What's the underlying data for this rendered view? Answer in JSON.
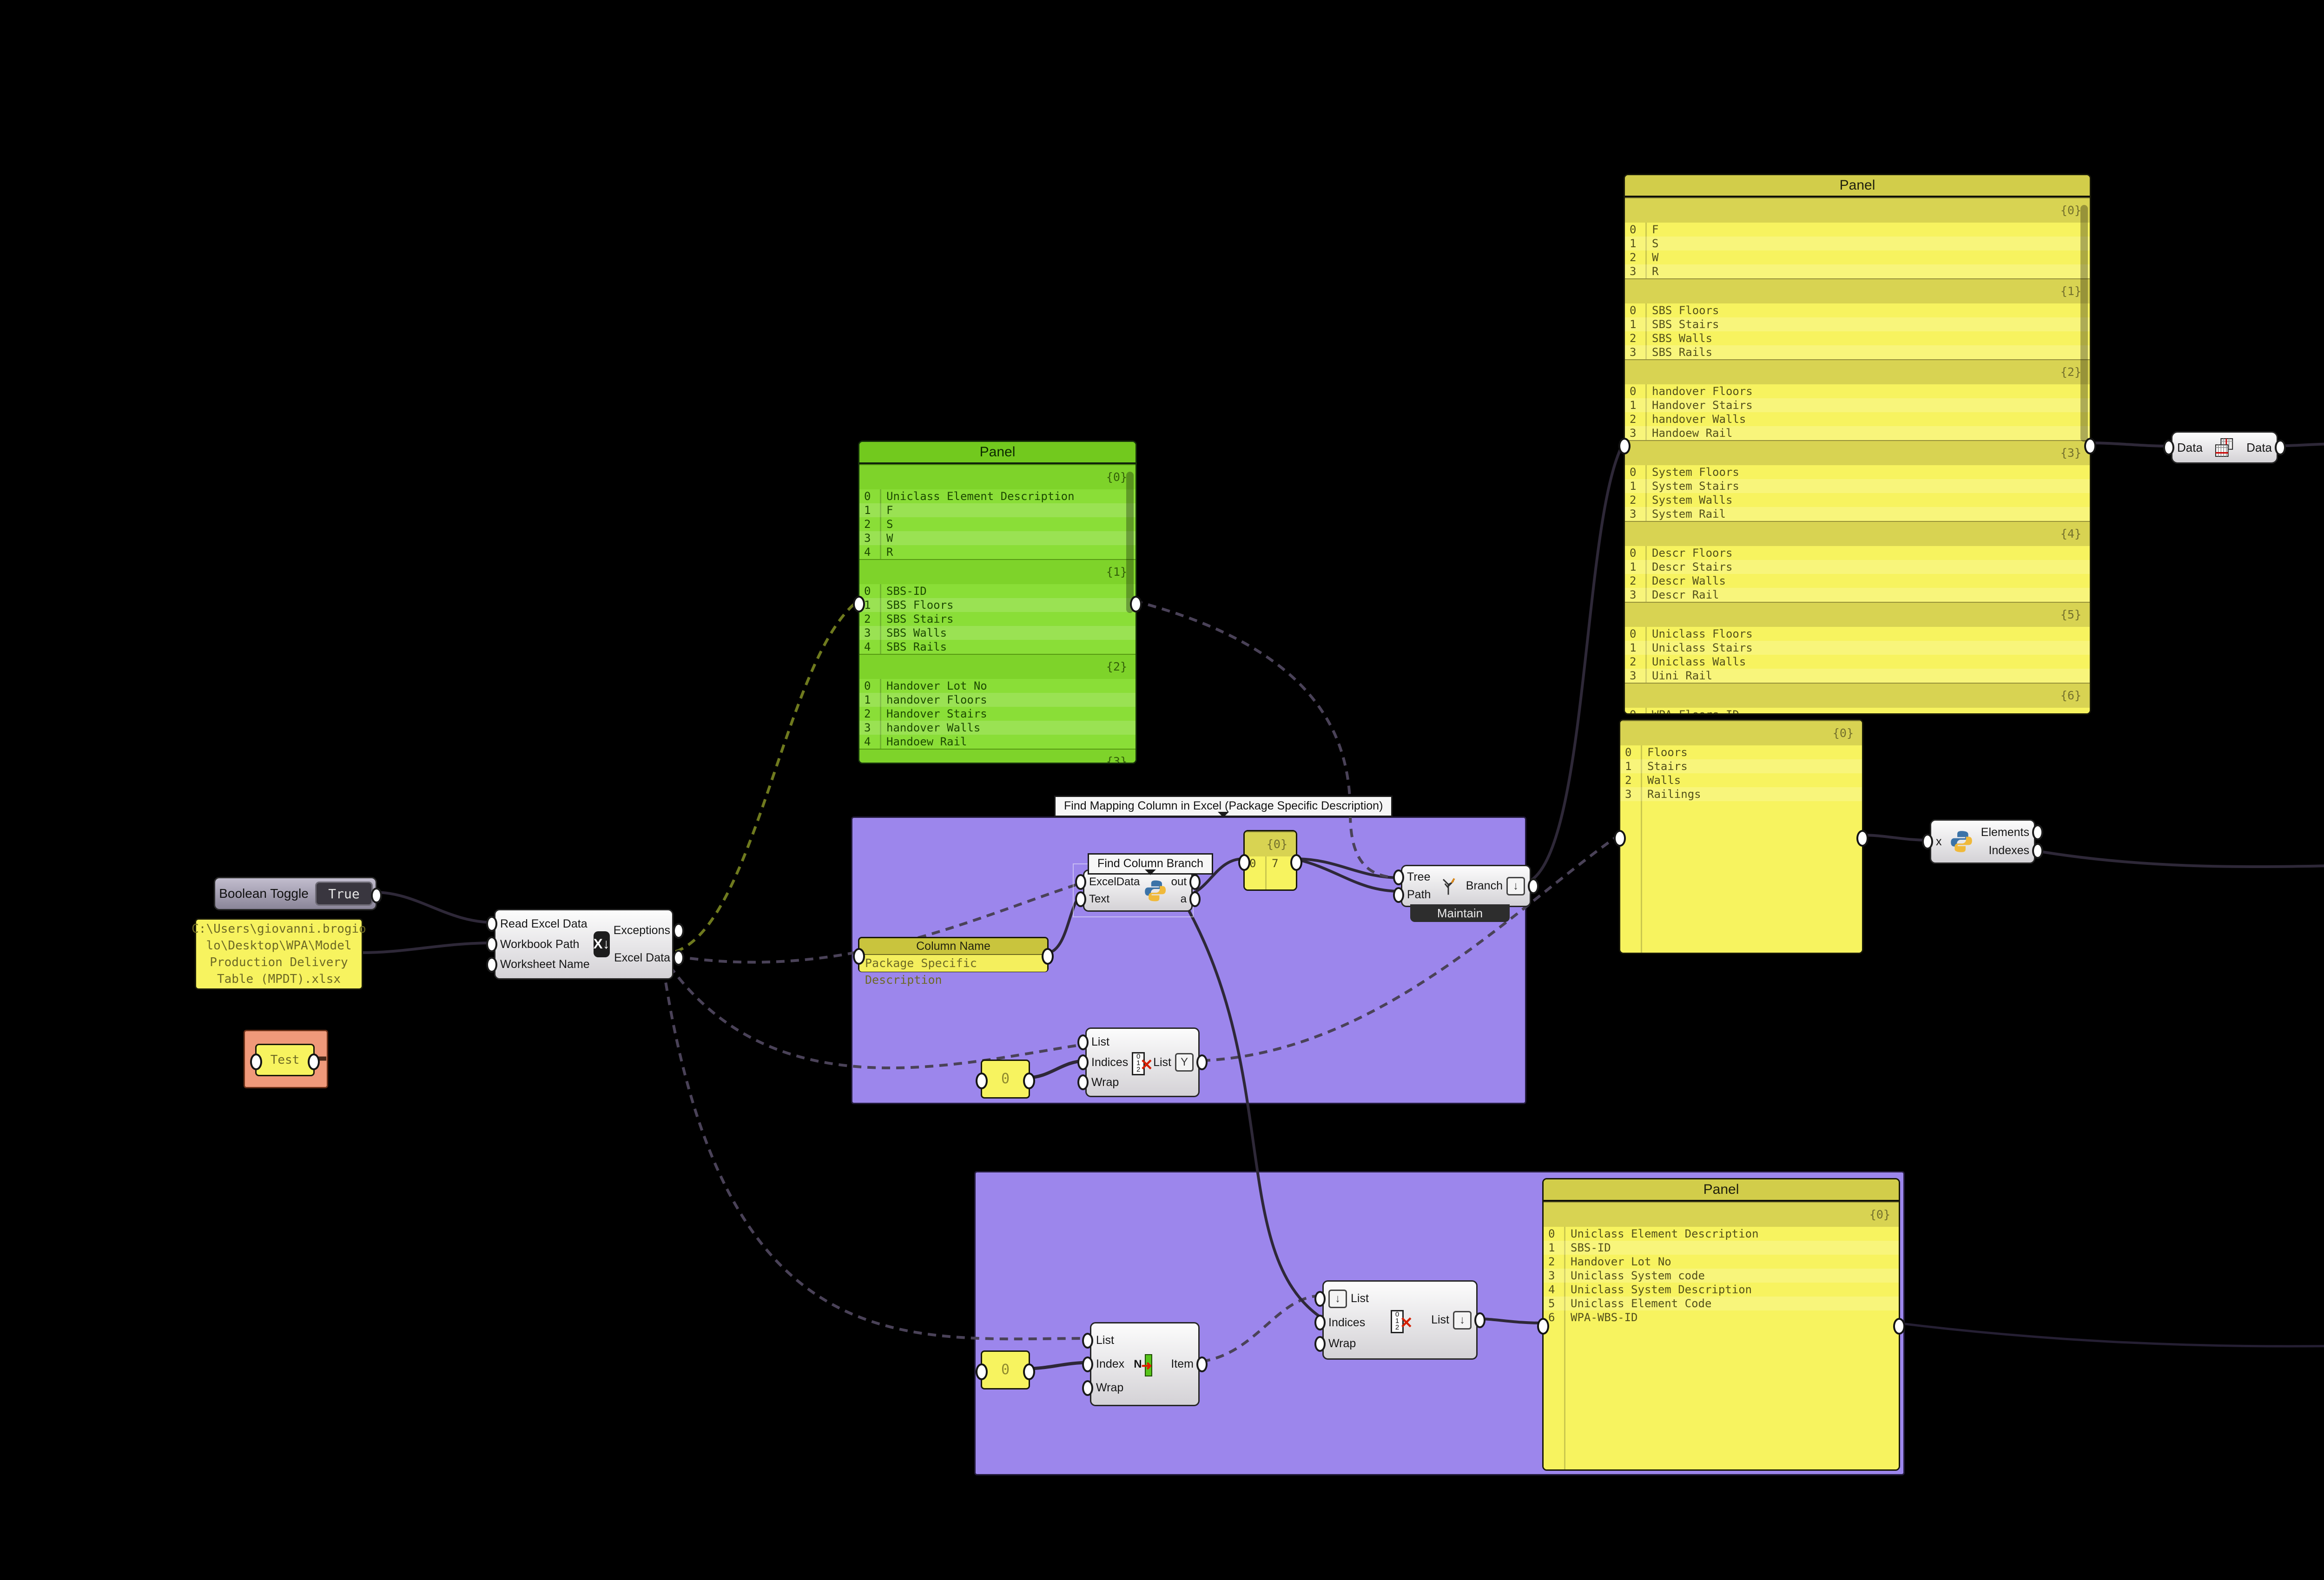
{
  "toggle": {
    "label": "Boolean Toggle",
    "value": "True"
  },
  "filepath_panel": {
    "text": "C:\\Users\\giovanni.brogio\nlo\\Desktop\\WPA\\Model\nProduction Delivery\nTable (MPDT).xlsx"
  },
  "test_group": {
    "panel_text": "Test"
  },
  "read_excel": {
    "inputs": [
      "Read Excel Data",
      "Workbook Path",
      "Worksheet Name"
    ],
    "outputs": [
      "Exceptions",
      "Excel Data"
    ],
    "icon_label": "X↓"
  },
  "group_find_mapping": {
    "tag": "Find Mapping Column in Excel (Package Specific Description)"
  },
  "find_column_branch": {
    "tag": "Find Column Branch",
    "inputs": [
      "ExcelData",
      "Text"
    ],
    "outputs": [
      "out",
      "a"
    ]
  },
  "column_name": {
    "title": "Column Name",
    "value": "Package Specific Description"
  },
  "col7_panel": {
    "sections": [
      {
        "key": "{0}",
        "rows": [
          "7"
        ]
      }
    ]
  },
  "tree_branch": {
    "inputs": [
      "Tree",
      "Path"
    ],
    "outputs": [
      "Branch"
    ],
    "mode": "Maintain"
  },
  "zero_a": {
    "value": "0"
  },
  "zero_b": {
    "value": "0"
  },
  "list_top": {
    "inputs": [
      "List",
      "Indices",
      "Wrap"
    ],
    "outputs": [
      "List"
    ]
  },
  "list_bottom_a": {
    "inputs": [
      "List",
      "Index",
      "Wrap"
    ],
    "outputs": [
      "Item"
    ]
  },
  "list_bottom_b": {
    "inputs": [
      "List",
      "Indices",
      "Wrap"
    ],
    "outputs": [
      "List"
    ]
  },
  "green_panel": {
    "title": "Panel",
    "sections": [
      {
        "key": "{0}",
        "rows": [
          "Uniclass Element Description",
          "F",
          "S",
          "W",
          "R"
        ]
      },
      {
        "key": "{1}",
        "rows": [
          "SBS-ID",
          "SBS Floors",
          "SBS Stairs",
          "SBS Walls",
          "SBS Rails"
        ]
      },
      {
        "key": "{2}",
        "rows": [
          "Handover Lot No",
          "handover Floors",
          "Handover Stairs",
          "handover Walls",
          "Handoew Rail"
        ]
      },
      {
        "key": "{3}",
        "rows": [
          "Uniclass System code"
        ]
      }
    ]
  },
  "big_panel": {
    "title": "Panel",
    "sections": [
      {
        "key": "{0}",
        "rows": [
          "F",
          "S",
          "W",
          "R"
        ]
      },
      {
        "key": "{1}",
        "rows": [
          "SBS Floors",
          "SBS Stairs",
          "SBS Walls",
          "SBS Rails"
        ]
      },
      {
        "key": "{2}",
        "rows": [
          "handover Floors",
          "Handover Stairs",
          "handover Walls",
          "Handoew Rail"
        ]
      },
      {
        "key": "{3}",
        "rows": [
          "System Floors",
          "System Stairs",
          "System Walls",
          "System Rail"
        ]
      },
      {
        "key": "{4}",
        "rows": [
          "Descr Floors",
          "Descr Stairs",
          "Descr Walls",
          "Descr Rail"
        ]
      },
      {
        "key": "{5}",
        "rows": [
          "Uniclass Floors",
          "Uniclass Stairs",
          "Uniclass Walls",
          "Uini Rail"
        ]
      },
      {
        "key": "{6}",
        "rows": [
          "WPA Floors ID",
          "WPA Stairs ID",
          "WPA Walls ID"
        ]
      }
    ]
  },
  "floors_panel": {
    "sections": [
      {
        "key": "{0}",
        "rows": [
          "Floors",
          "Stairs",
          "Walls",
          "Railings"
        ]
      }
    ]
  },
  "data_comp": {
    "input": "Data",
    "output": "Data"
  },
  "python_elements": {
    "inputs": [
      "x"
    ],
    "outputs": [
      "Elements",
      "Indexes"
    ]
  },
  "python_indexes": {
    "inputs": [
      "x",
      "Indexes"
    ],
    "outputs": [
      "out",
      "a"
    ]
  },
  "right_top_panel": {
    "title": "Panel",
    "sections": [
      {
        "key": "{0}",
        "rows": [
          "F",
          "SBS Floors",
          "handover Floors",
          "System Floors",
          "Descr Floors",
          "Uniclass Floors",
          "WPA Floors ID",
          "Floors"
        ]
      },
      {
        "key": "{1}",
        "rows": [
          "S",
          "SBS Stairs",
          "Handover Stairs",
          "System Stairs",
          "Descr Stairs",
          "Uniclass Stairs",
          "WPA Stairs ID",
          "Stairs"
        ]
      },
      {
        "key": "{2}",
        "rows": [
          "W",
          "SBS Walls",
          "handover Walls"
        ]
      }
    ]
  },
  "right_mid_panel": {
    "title": "Panel",
    "sections": [
      {
        "key": "{0}",
        "rows": [
          "F",
          "SBS Floors",
          "handover Floors",
          "System Floors",
          "Descr Floors",
          "Uniclass Floors",
          "WPA Floors ID",
          "Floors"
        ]
      },
      {
        "key": "{1}",
        "rows": [
          "F",
          "SBS Floors",
          "handover Floors",
          "System Floors",
          "Descr Floors"
        ]
      }
    ]
  },
  "mapping_panel": {
    "title": "Panel",
    "sections": [
      {
        "key": "{0}",
        "rows": [
          "Uniclass Element Description",
          "SBS-ID",
          "Handover Lot No",
          "Uniclass System code",
          "Uniclass System Description",
          "Uniclass Element Code",
          "WPA-WBS-ID"
        ]
      }
    ]
  },
  "set_params": {
    "tag": "Set Element Parameters",
    "inputs": [
      "elements",
      "paramNames",
      "paramValues"
    ],
    "outputs": [
      "updated",
      "errors",
      "reports"
    ]
  },
  "result_panel_count": {
    "sections": [
      {
        "key": "{0}",
        "rows": [
          "154"
        ]
      }
    ]
  },
  "result_panel_errors": {
    "sections": [
      {
        "key": "{0}",
        "rows": []
      }
    ]
  },
  "result_panel_reports": {
    "sections": [
      {
        "key": "{0}",
        "rows": []
      }
    ]
  },
  "colors": {
    "group_purple": "#9c86ec",
    "group_orange": "#f0997a",
    "panel_yellow": "#f7f35f",
    "panel_green": "#8ade37",
    "wire_error": "#ff2d00"
  }
}
